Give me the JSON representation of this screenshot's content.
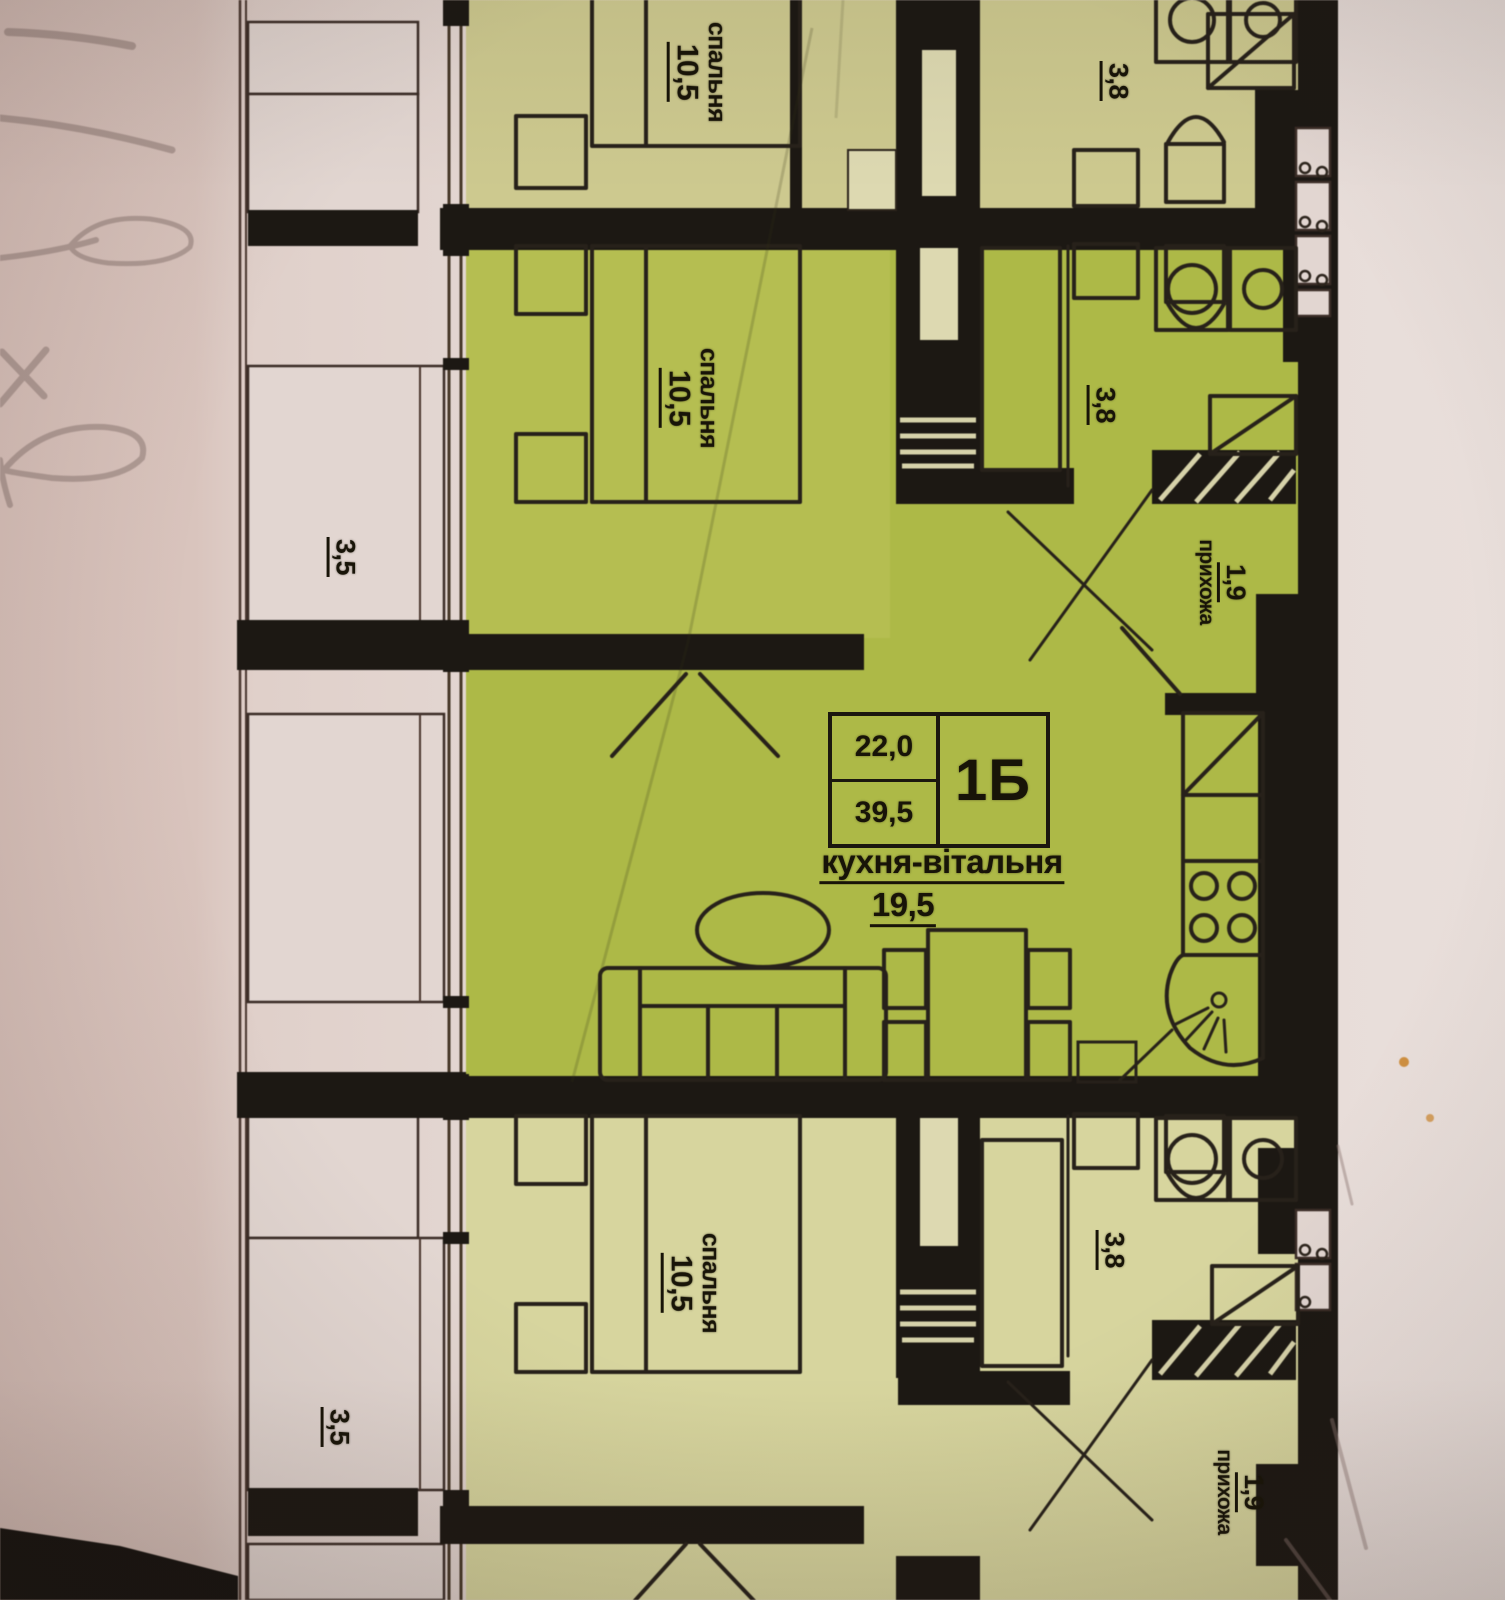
{
  "photo": {
    "kind": "photographed apartment floor plan",
    "language": "Ukrainian"
  },
  "apartment_card": {
    "code": "1Б",
    "area_top": "22,0",
    "area_bottom": "39,5"
  },
  "labels": {
    "kitchen_living": {
      "name": "кухня-вітальня",
      "area": "19,5"
    },
    "bedroom": {
      "name": "спальня",
      "area": "10,5"
    },
    "hallway": {
      "name": "прихожа",
      "area": "1,9"
    },
    "bathroom": {
      "area": "3,8"
    },
    "balcony": {
      "area": "3,5"
    }
  },
  "instances": {
    "bedroom_labels": 3,
    "bathroom_labels": 3,
    "hallway_labels": 2,
    "balcony_labels": 2
  },
  "handwriting_note": "illegible pencil marks on paper margin",
  "colors": {
    "paper_left": "#d6bfb8",
    "paper_mid": "#e3d6d1",
    "paper_right": "#e9dfdb",
    "apartment_middle": "#adb945",
    "apartment_top": "#cdc98e",
    "apartment_bottom": "#d7d59d",
    "bedroom_tint": "#c9cb66",
    "walls": "#1c1813",
    "balcony_fill": "#e2d6d1",
    "slot_fill": "#ddd9b0",
    "furniture_line": "#27211a",
    "text": "#181408",
    "pencil": "#8d7873",
    "speck": "#cf8f3f"
  }
}
